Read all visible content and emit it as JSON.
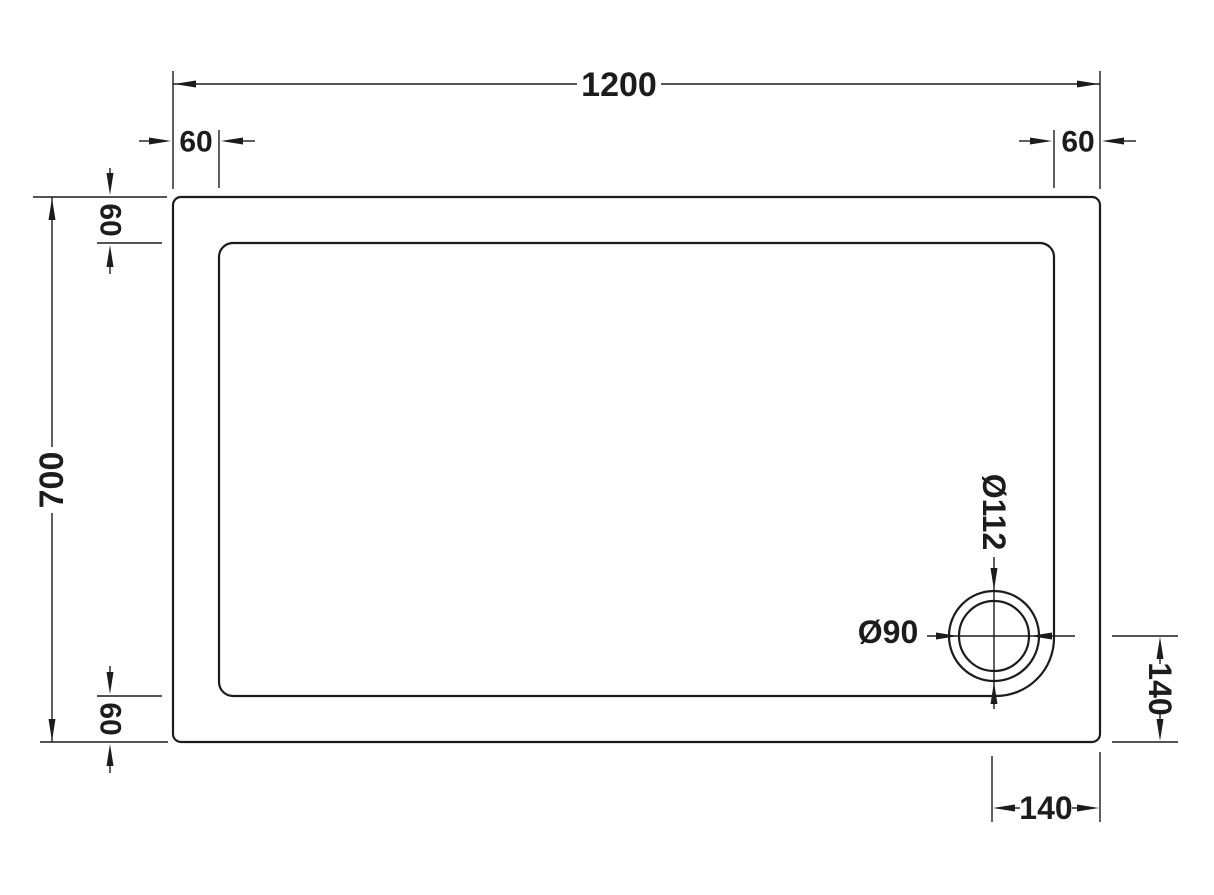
{
  "canvas": {
    "background": "#ffffff",
    "line_color": "#1c1c1c"
  },
  "dimensions": {
    "overall_width": "1200",
    "overall_height": "700",
    "top_left_offset": "60",
    "top_right_offset": "60",
    "left_top_inset": "60",
    "left_bottom_inset": "60",
    "waste_outer_diameter": "Ø112",
    "waste_inner_diameter": "Ø90",
    "waste_offset_from_right": "140",
    "waste_offset_from_bottom": "140"
  }
}
